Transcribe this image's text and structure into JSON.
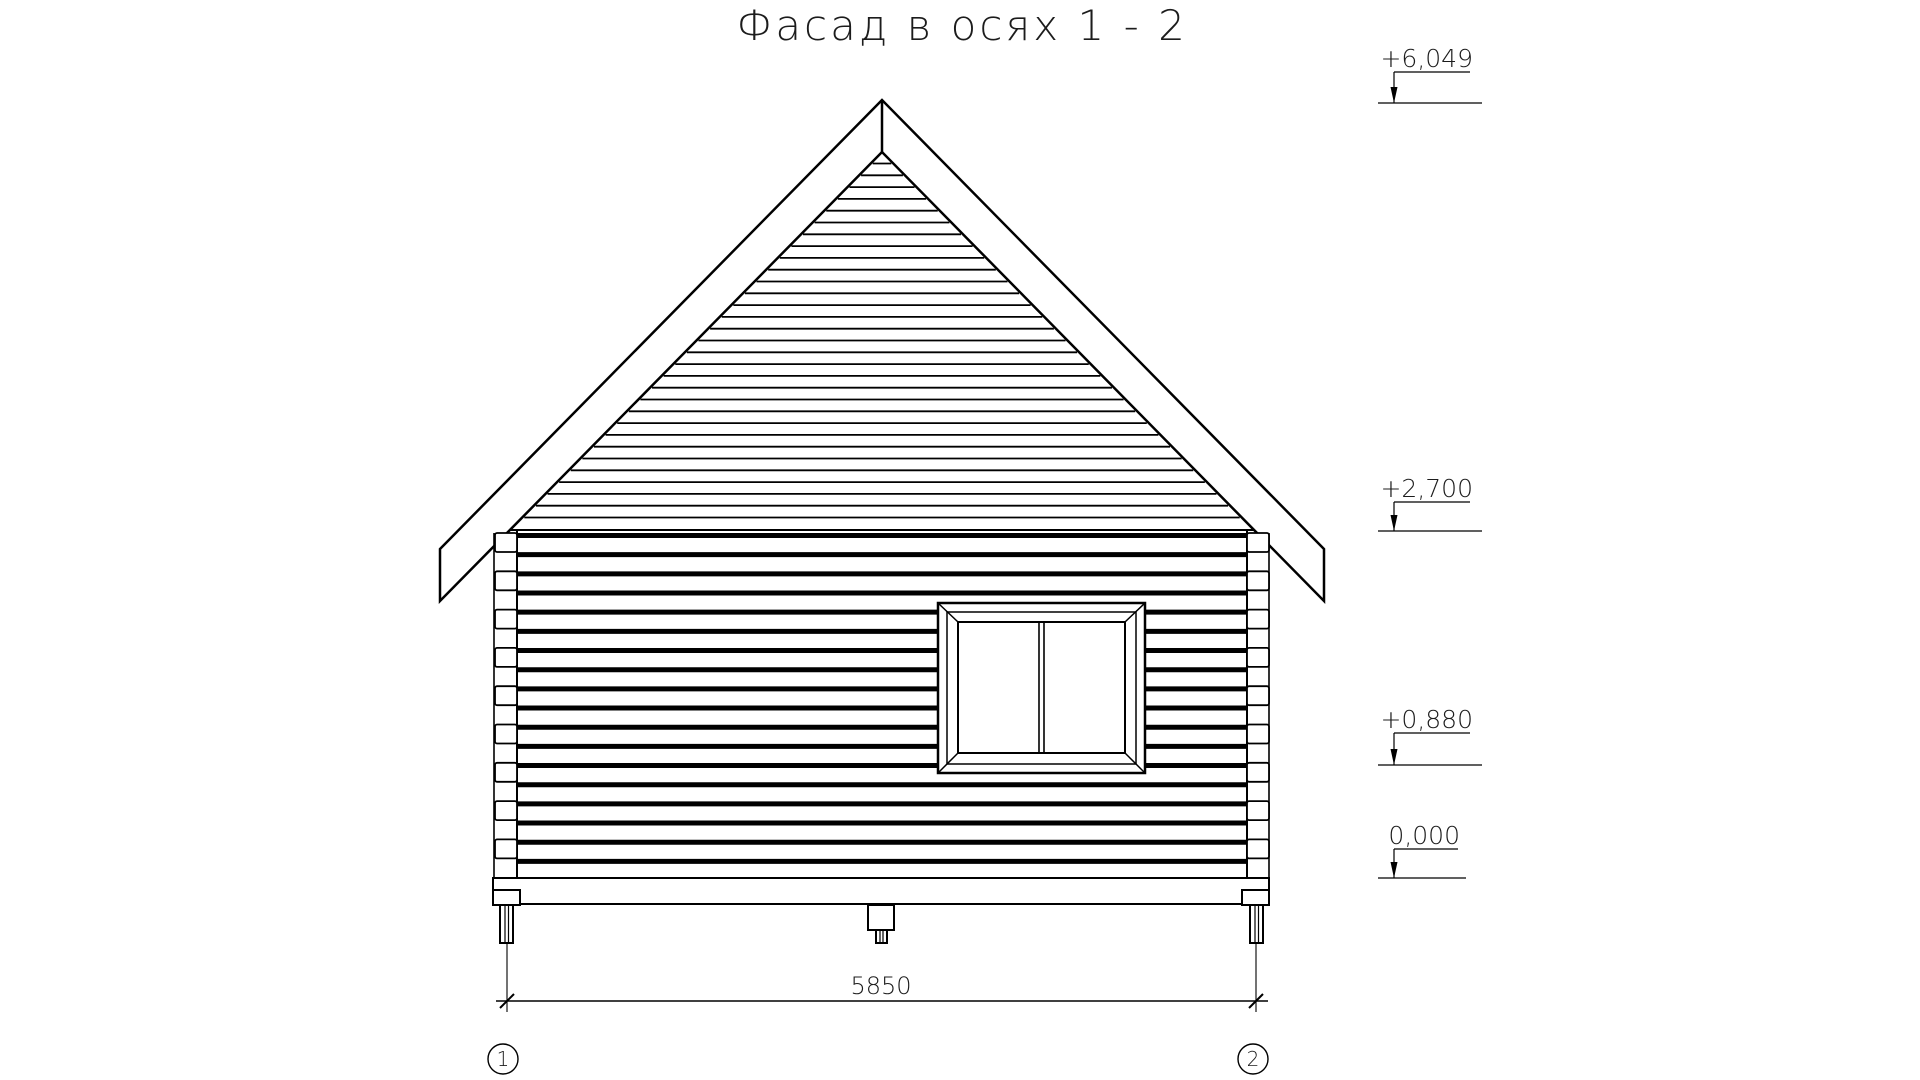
{
  "title": "Фасад в осях 1 - 2",
  "colors": {
    "line": "#000000",
    "text": "#1c1c1c",
    "background": "#ffffff"
  },
  "elevation_marks": [
    {
      "label": "+6,049"
    },
    {
      "label": "+2,700"
    },
    {
      "label": "+0,880"
    },
    {
      "label": "0,000"
    }
  ],
  "dimension": {
    "label": "5850"
  },
  "axis_markers": [
    {
      "label": "1"
    },
    {
      "label": "2"
    }
  ]
}
